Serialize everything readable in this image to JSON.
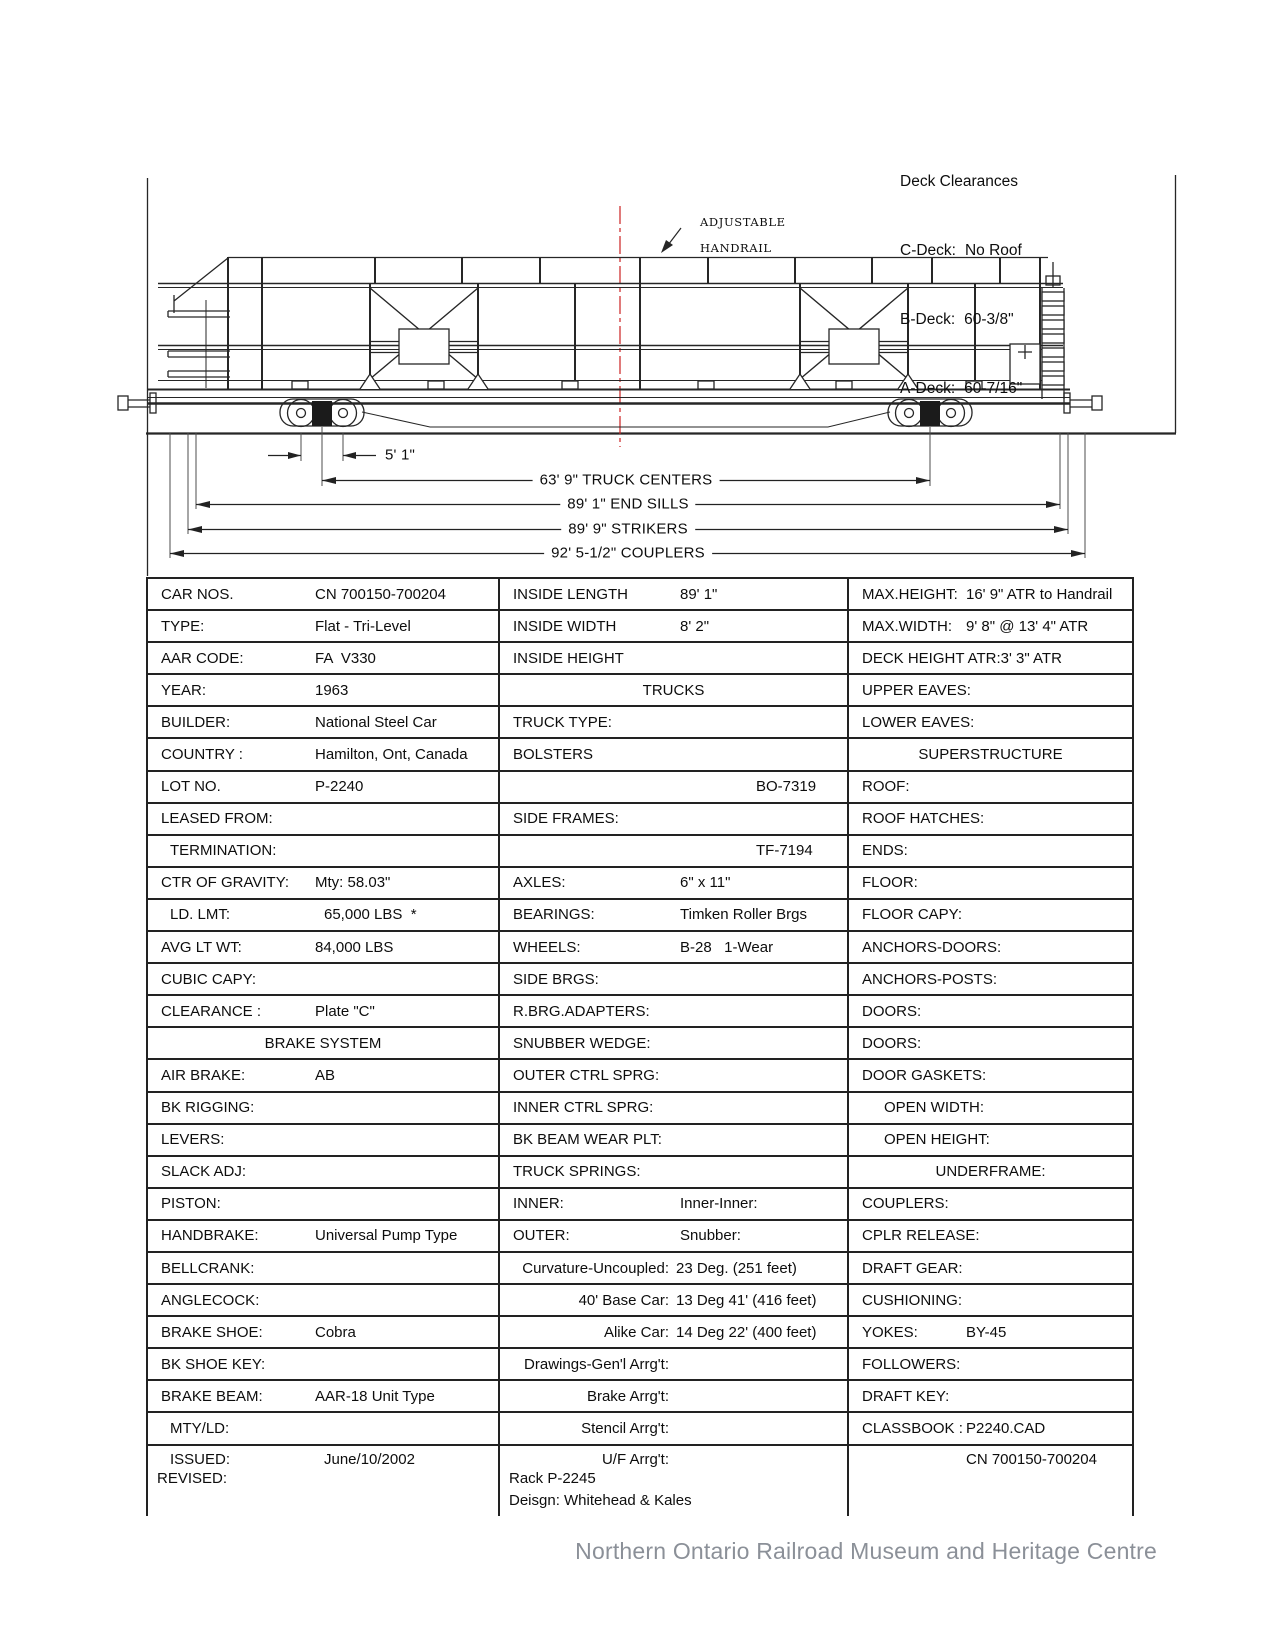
{
  "colors": {
    "ink": "#222222",
    "centerline_red": "#cc2222",
    "footer_gray": "#8b9098"
  },
  "deck_clearances": {
    "title": "Deck Clearances",
    "items": [
      {
        "label": "C-Deck:",
        "value": "No Roof"
      },
      {
        "label": "B-Deck:",
        "value": "60-3/8\""
      },
      {
        "label": "A-Deck:",
        "value": "60-7/16\""
      }
    ]
  },
  "diagram": {
    "handrail_note_line1": "ADJUSTABLE",
    "handrail_note_line2": "HANDRAIL"
  },
  "dimensions": {
    "axle_spacing": "5' 1\"",
    "truck_centers": "63' 9\" TRUCK CENTERS",
    "end_sills": "89' 1\" END SILLS",
    "strikers": "89' 9\" STRIKERS",
    "couplers": "92' 5-1/2\" COUPLERS"
  },
  "table": {
    "left": [
      {
        "label": "CAR NOS.",
        "value": "CN 700150-700204"
      },
      {
        "label": "TYPE:",
        "value": "Flat - Tri-Level"
      },
      {
        "label": "AAR CODE:",
        "value": "FA  V330"
      },
      {
        "label": "YEAR:",
        "value": "1963"
      },
      {
        "label": "BUILDER:",
        "value": "National Steel Car"
      },
      {
        "label": "COUNTRY :",
        "value": "Hamilton, Ont, Canada"
      },
      {
        "label": "LOT NO.",
        "value": "P-2240"
      },
      {
        "label": "LEASED FROM:",
        "value": ""
      },
      {
        "label": "TERMINATION:",
        "value": "",
        "indent": 1
      },
      {
        "label": "CTR OF GRAVITY:",
        "value": "Mty: 58.03\""
      },
      {
        "label": "LD. LMT:",
        "value": "65,000 LBS  *",
        "indent": 1
      },
      {
        "label": "AVG LT WT:",
        "value": "84,000 LBS"
      },
      {
        "label": "CUBIC CAPY:",
        "value": ""
      },
      {
        "label": "CLEARANCE :",
        "value": "Plate \"C\""
      },
      {
        "style": "header",
        "label": "BRAKE SYSTEM"
      },
      {
        "label": "AIR BRAKE:",
        "value": "AB"
      },
      {
        "label": "BK RIGGING:",
        "value": ""
      },
      {
        "label": "LEVERS:",
        "value": ""
      },
      {
        "label": "SLACK ADJ:",
        "value": ""
      },
      {
        "label": "PISTON:",
        "value": ""
      },
      {
        "label": "HANDBRAKE:",
        "value": "Universal Pump Type"
      },
      {
        "label": "BELLCRANK:",
        "value": ""
      },
      {
        "label": "ANGLECOCK:",
        "value": ""
      },
      {
        "label": "BRAKE SHOE:",
        "value": "Cobra"
      },
      {
        "label": "BK SHOE KEY:",
        "value": ""
      },
      {
        "label": "BRAKE BEAM:",
        "value": "AAR-18 Unit Type"
      },
      {
        "label": "MTY/LD:",
        "value": "",
        "indent": 1
      },
      {
        "label": "ISSUED:",
        "value": "June/10/2002",
        "indent": 1,
        "extra_lines": [
          "REVISED:"
        ]
      }
    ],
    "middle": [
      {
        "label": "INSIDE LENGTH",
        "value": "89' 1\""
      },
      {
        "label": "INSIDE WIDTH",
        "value": "8' 2\""
      },
      {
        "label": "INSIDE HEIGHT",
        "value": ""
      },
      {
        "style": "header",
        "label": "TRUCKS"
      },
      {
        "label": "TRUCK TYPE:",
        "value": ""
      },
      {
        "label": "BOLSTERS",
        "value": ""
      },
      {
        "style": "indent-value",
        "label": "",
        "value": "BO-7319"
      },
      {
        "label": "SIDE FRAMES:",
        "value": ""
      },
      {
        "style": "indent-value",
        "label": "",
        "value": "TF-7194"
      },
      {
        "label": "AXLES:",
        "value": "6\" x 11\""
      },
      {
        "label": "BEARINGS:",
        "value": "Timken Roller Brgs"
      },
      {
        "label": "WHEELS:",
        "value": "B-28   1-Wear"
      },
      {
        "label": "SIDE BRGS:",
        "value": ""
      },
      {
        "label": "R.BRG.ADAPTERS:",
        "value": ""
      },
      {
        "label": "SNUBBER WEDGE:",
        "value": ""
      },
      {
        "label": "OUTER CTRL SPRG:",
        "value": ""
      },
      {
        "label": "INNER CTRL SPRG:",
        "value": ""
      },
      {
        "label": "BK BEAM WEAR PLT:",
        "value": ""
      },
      {
        "label": "TRUCK SPRINGS:",
        "value": ""
      },
      {
        "label": "INNER:",
        "value": "Inner-Inner:"
      },
      {
        "label": "OUTER:",
        "value": "Snubber:"
      },
      {
        "style": "right-label",
        "label": "Curvature-Uncoupled:",
        "value": "23 Deg. (251 feet)"
      },
      {
        "style": "right-label",
        "label": "40' Base Car:",
        "value": "13 Deg 41' (416 feet)"
      },
      {
        "style": "right-label",
        "label": "Alike Car:",
        "value": "14 Deg 22' (400 feet)"
      },
      {
        "style": "right-label",
        "label": "Drawings-Gen'l Arrg't:",
        "value": ""
      },
      {
        "style": "right-label",
        "label": "Brake Arrg't:",
        "value": ""
      },
      {
        "style": "right-label",
        "label": "Stencil Arrg't:",
        "value": ""
      },
      {
        "style": "right-label",
        "label": "U/F Arrg't:",
        "value": "",
        "extra_lines": [
          "Rack P-2245",
          "Deisgn: Whitehead & Kales"
        ]
      }
    ],
    "right": [
      {
        "label": "MAX.HEIGHT:",
        "value": "16' 9\" ATR to Handrail"
      },
      {
        "label": "MAX.WIDTH:",
        "value": "9' 8\" @ 13' 4\" ATR"
      },
      {
        "label": "DECK HEIGHT ATR:",
        "value": "3' 3\" ATR"
      },
      {
        "label": "UPPER EAVES:",
        "value": ""
      },
      {
        "label": "LOWER EAVES:",
        "value": ""
      },
      {
        "style": "header",
        "label": "SUPERSTRUCTURE"
      },
      {
        "label": "ROOF:",
        "value": ""
      },
      {
        "label": "ROOF HATCHES:",
        "value": ""
      },
      {
        "label": "ENDS:",
        "value": ""
      },
      {
        "label": "FLOOR:",
        "value": ""
      },
      {
        "label": "FLOOR CAPY:",
        "value": ""
      },
      {
        "label": "ANCHORS-DOORS:",
        "value": ""
      },
      {
        "label": "ANCHORS-POSTS:",
        "value": ""
      },
      {
        "label": "DOORS:",
        "value": ""
      },
      {
        "label": "DOORS:",
        "value": ""
      },
      {
        "label": "DOOR GASKETS:",
        "value": ""
      },
      {
        "label": "OPEN WIDTH:",
        "value": "",
        "indent": 2
      },
      {
        "label": "OPEN HEIGHT:",
        "value": "",
        "indent": 2
      },
      {
        "style": "header",
        "label": "UNDERFRAME:"
      },
      {
        "label": "COUPLERS:",
        "value": ""
      },
      {
        "label": "CPLR RELEASE:",
        "value": ""
      },
      {
        "label": "DRAFT GEAR:",
        "value": ""
      },
      {
        "label": "CUSHIONING:",
        "value": ""
      },
      {
        "label": "YOKES:",
        "value": "BY-45"
      },
      {
        "label": "FOLLOWERS:",
        "value": ""
      },
      {
        "label": "DRAFT KEY:",
        "value": ""
      },
      {
        "label": "CLASSBOOK :",
        "value": "P2240.CAD"
      },
      {
        "style": "value-only",
        "label": "",
        "value": "CN 700150-700204"
      }
    ]
  },
  "footer": {
    "text": "Northern Ontario Railroad Museum and Heritage Centre"
  }
}
